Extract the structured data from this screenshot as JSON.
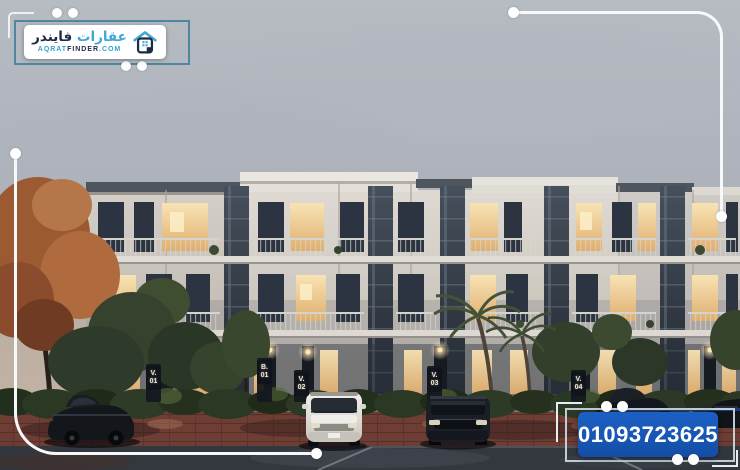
{
  "brand": {
    "logo_ar_word1": "عقارات",
    "logo_ar_word2": "فايندر",
    "logo_domain_part1": "AQRAT",
    "logo_domain_part2": "FINDER",
    "logo_domain_tld": ".COM",
    "accent_teal": "#3fa9d3",
    "dark_navy": "#1d2b45"
  },
  "contact": {
    "phone_number": "01093723625",
    "phone_box_blue": "#1757b8"
  },
  "scene": {
    "unit_signs": [
      {
        "line1": "V.",
        "line2": "01"
      },
      {
        "line1": "B.",
        "line2": "01"
      },
      {
        "line1": "V.",
        "line2": "02"
      },
      {
        "line1": "V.",
        "line2": "03"
      },
      {
        "line1": "V.",
        "line2": "04"
      }
    ]
  }
}
